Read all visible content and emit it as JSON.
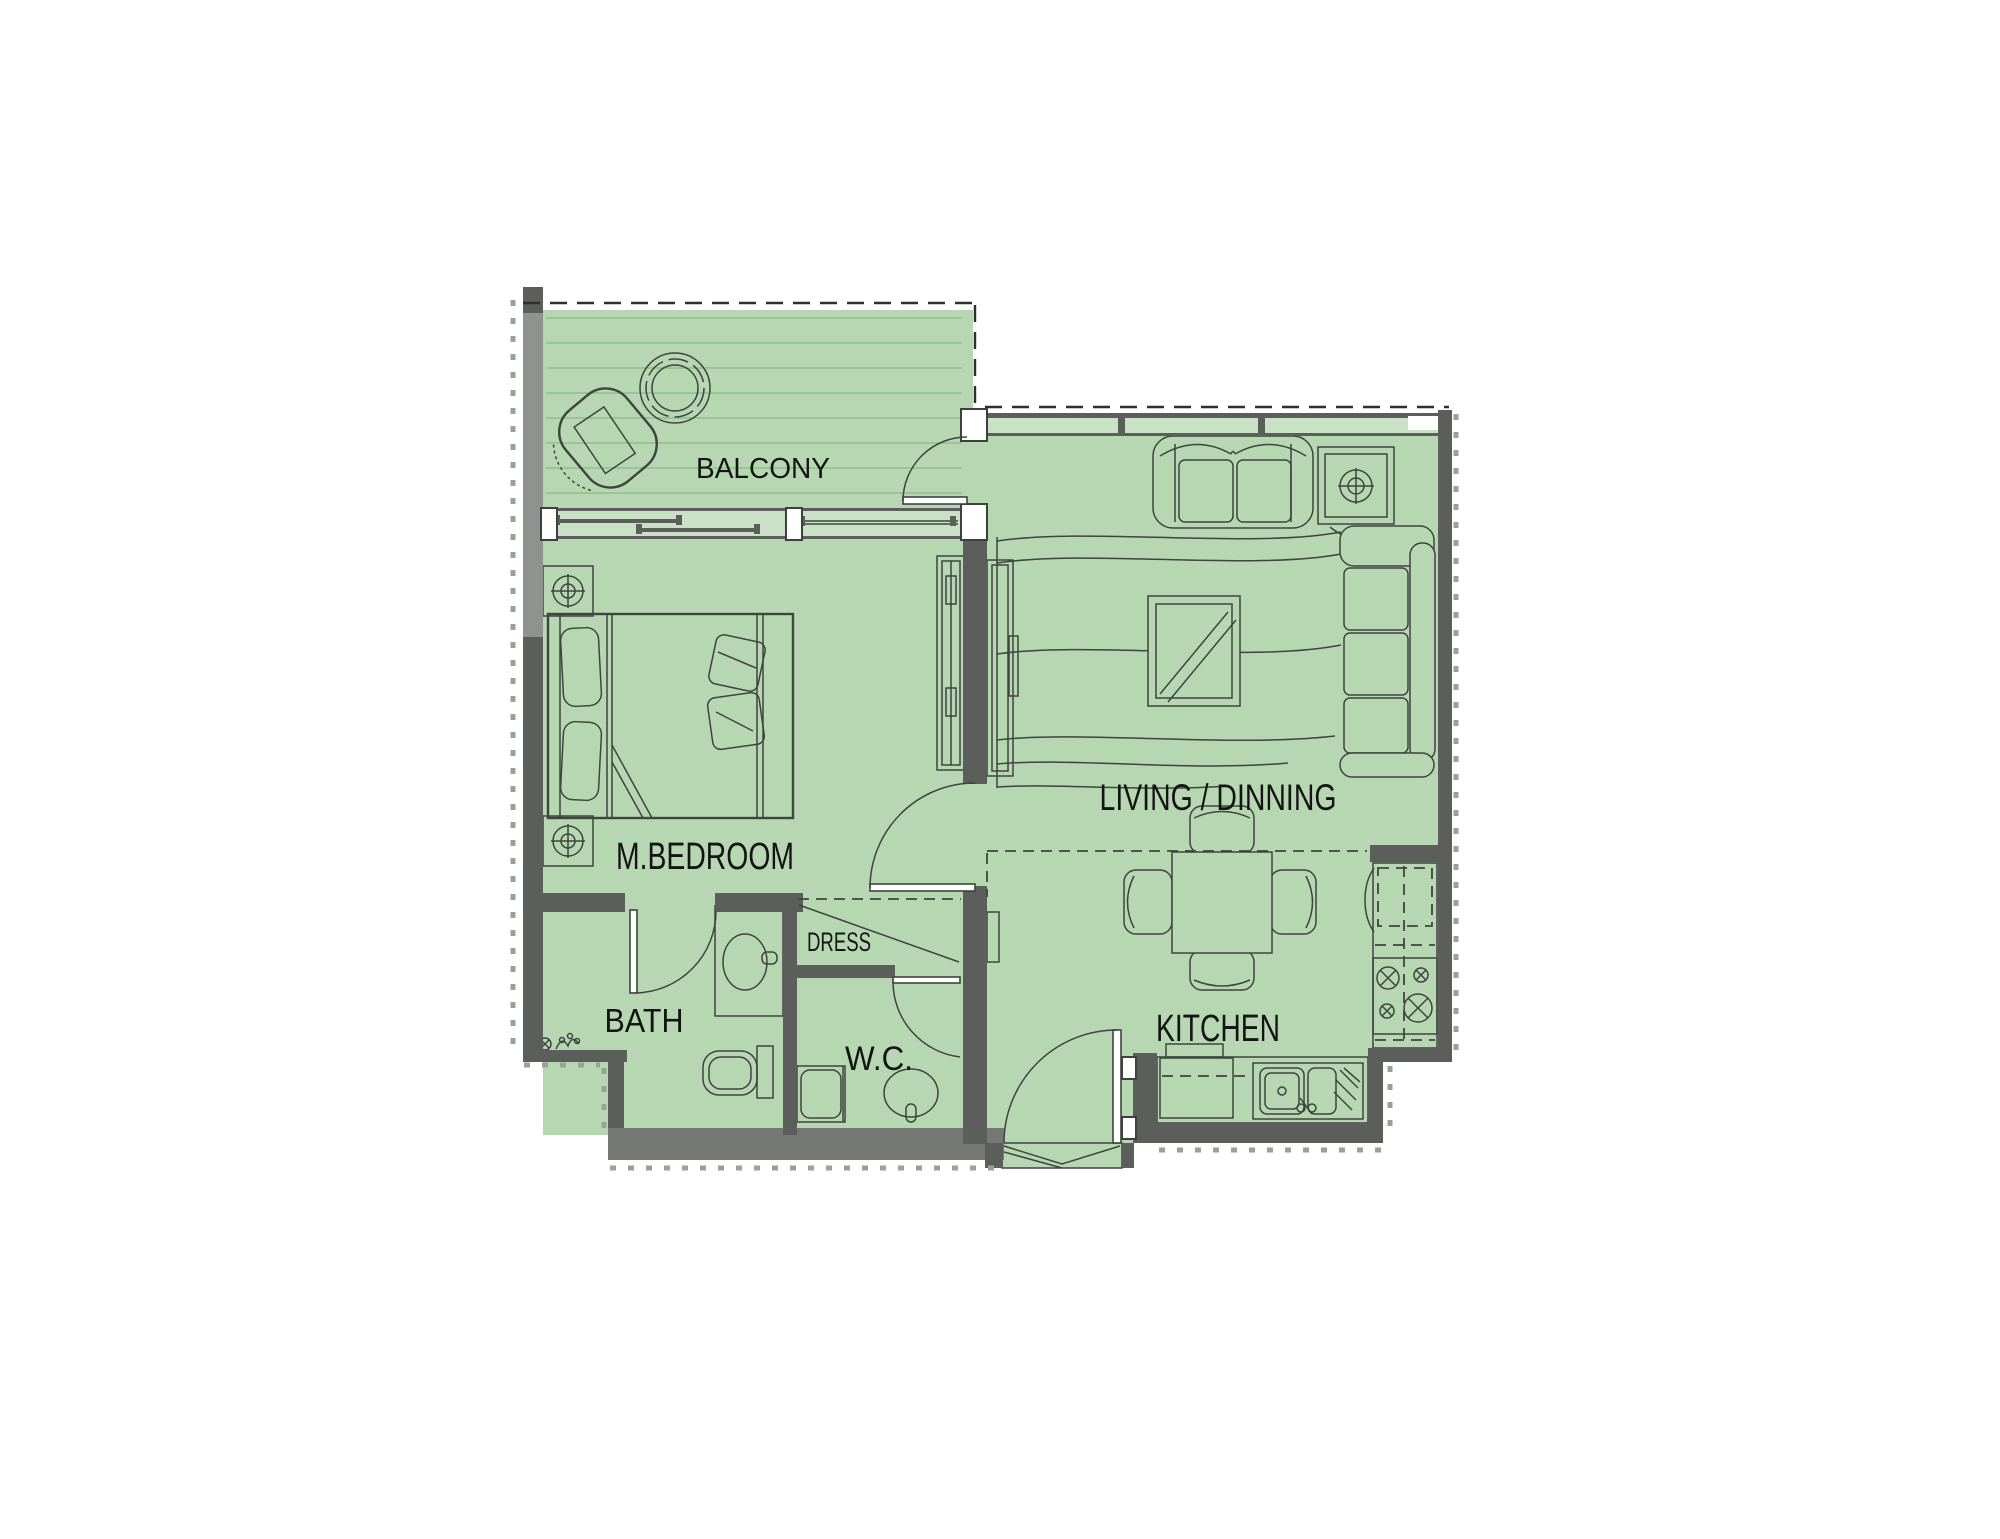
{
  "rooms": [
    {
      "id": "balcony",
      "label": "BALCONY"
    },
    {
      "id": "m-bedroom",
      "label": "M.BEDROOM"
    },
    {
      "id": "living-dinning",
      "label": "LIVING / DINNING"
    },
    {
      "id": "dress",
      "label": "DRESS"
    },
    {
      "id": "bath",
      "label": "BATH"
    },
    {
      "id": "wc",
      "label": "W.C."
    },
    {
      "id": "kitchen",
      "label": "KITCHEN"
    }
  ],
  "colors": {
    "floor": "#b6d7b2",
    "glazing": "#c9e2c5",
    "deck": "#8fbe8c",
    "wall": "#5b5e5b",
    "wall_light": "#8f938f",
    "band": "#757875",
    "line": "#3e443e",
    "label": "#141414",
    "dash": "#2e2e2e",
    "tick": "#9aa09a"
  }
}
